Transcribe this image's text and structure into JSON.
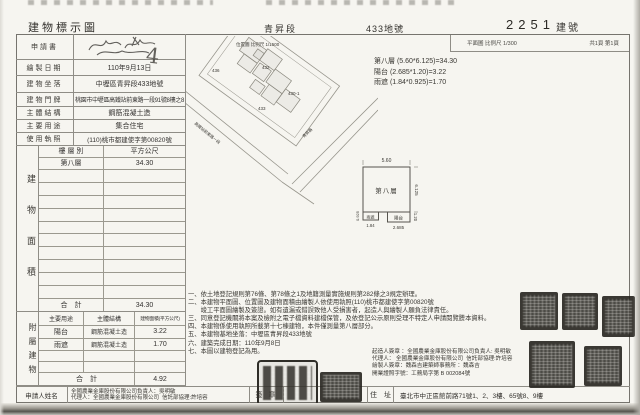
{
  "header": {
    "title": "建物標示圖",
    "section": "青昇段",
    "parcel": "433地號",
    "building_no": "2251",
    "building_no_suffix": "建號",
    "plan_scale": "平面圖  比例尺  1/300",
    "page_info": "共1頁 第1頁"
  },
  "map": {
    "scale_label": "位置圖  比例尺  1/1500",
    "parcel_labels": [
      "436",
      "432",
      "430-1",
      "433"
    ],
    "road_left": "高鐵站前東路一段",
    "road_right": "青昇路",
    "handwritten_mark": "4"
  },
  "fields": [
    {
      "label": "申請書",
      "value": ""
    },
    {
      "label": "繪製日期",
      "value": "110年9月13日"
    },
    {
      "label": "建物坐落",
      "value": "中壢區青昇段433地號"
    },
    {
      "label": "建物門牌",
      "value": "桃園市中壢區高鐵站前東路一段91號8樓之8"
    },
    {
      "label": "主體結構",
      "value": "鋼筋混凝土造"
    },
    {
      "label": "主要用途",
      "value": "集合住宅"
    },
    {
      "label": "使用執照",
      "value": "(110)桃市都建使字第00820號"
    }
  ],
  "area_table": {
    "side_label": "建物面積",
    "col_floor": "樓 層 別",
    "col_area": "平方公尺",
    "floor_label": "第八層",
    "floor_area": "34.30",
    "total_label": "合　計",
    "total_area": "34.30"
  },
  "annex_table": {
    "side_label": "附屬建物",
    "col_use": "主要用途",
    "col_structure": "主體結構",
    "col_area": "建物面積(平方公尺)",
    "rows": [
      {
        "use": "陽台",
        "structure": "鋼筋混凝土造",
        "area": "3.22"
      },
      {
        "use": "雨遮",
        "structure": "鋼筋混凝土造",
        "area": "1.70"
      }
    ],
    "total_label": "合　計",
    "total_area": "4.92"
  },
  "applicant": {
    "label": "申請人姓名",
    "line1": "全國農業金庫股份有限公司負責人：吳明敏",
    "line2": "代理人：全國農業金庫股份有限公司  信託部協理:許培容",
    "seal_label": "簽 章"
  },
  "calculations": {
    "line1": "第八層 (5.60*6.125)=34.30",
    "line2": "陽台 (2.685*1.20)=3.22",
    "line3": "雨遮 (1.84*0.925)=1.70"
  },
  "floor_plan": {
    "room": "第八層",
    "width": "5.60",
    "height": "6.125",
    "balcony": "陽台",
    "balcony_width": "2.685",
    "balcony_height": "1.20",
    "canopy": "雨遮",
    "canopy_width": "1.84",
    "canopy_height": "0.925"
  },
  "notes": [
    "一、依土地登記規則第76條、第78條之1及地籍測量實施規則第282條之3規定辦理。",
    "二、本建物平面圖、位置圖及建物面積由繪製人依使用執照(110)桃市都建使字第00820號",
    "　　竣工平面圖繪製及簽證。如有遺漏或錯誤致他人受損害者，起造人與繪製人願負法律責任。",
    "三、同意登記機關將本案及檢附之電子檔資料建檔保管，及依登記公示原則受理不特定人申請閱覽謄本資料。",
    "四、本建物係使用執照所載第十七棟建物，本件僅測量第八層部分。",
    "五、本建物基地坐落：中壢區青昇段433地號",
    "六、建築完成日期：110年9月8日",
    "七、本圖以建物登記為用。"
  ],
  "signatures": {
    "line1": "起造人簽章 ：全國農業金庫股份有限公司負責人: 吳明敏",
    "line2": "代理人： 全國農業金庫股份有限公司  信託部協理:許培容",
    "line3": "繪製人簽章：魏森吉建築師事務所 ：魏森吉",
    "line4": "開業證照字號：工務局字第 B 002084號"
  },
  "address": {
    "label": "住　址",
    "value": "臺北市中正區館前路71號1、2、3樓、65號8、9樓"
  }
}
